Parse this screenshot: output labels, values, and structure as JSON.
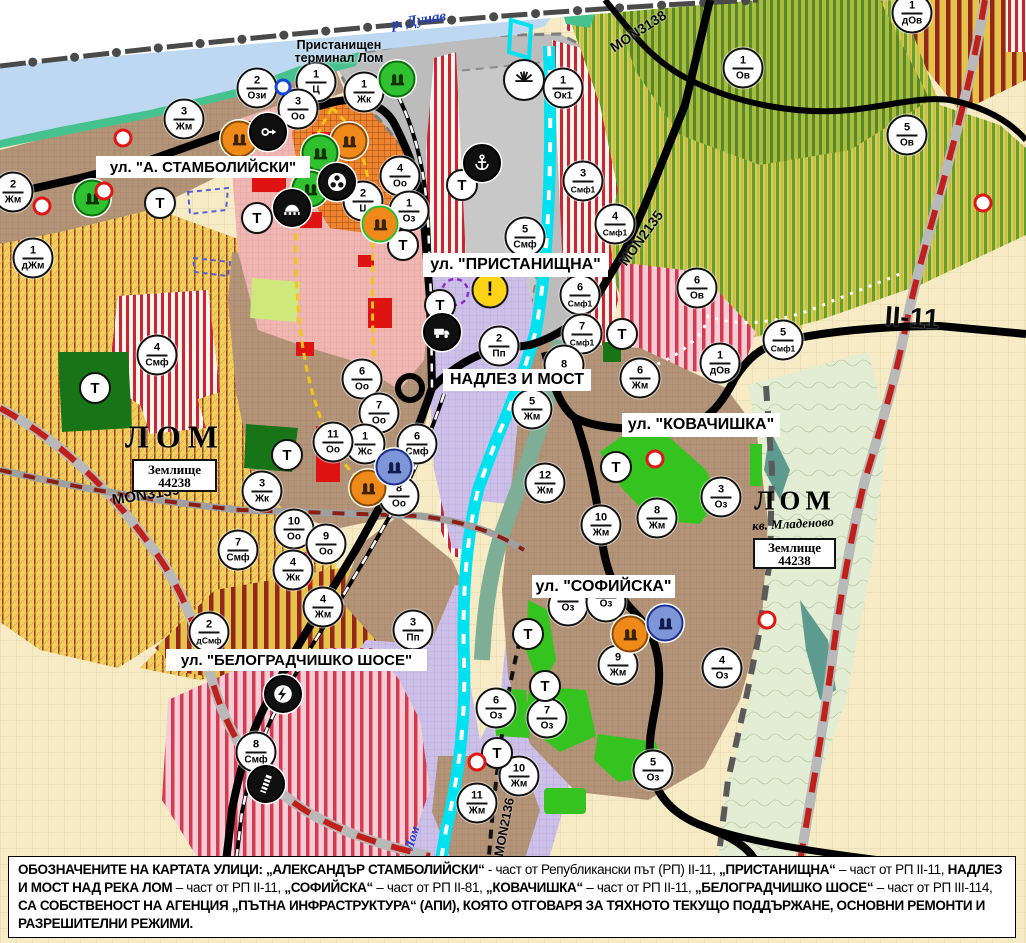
{
  "map": {
    "colors": {
      "water": "#bdd8f0",
      "coast": "#46c28e",
      "port_gray": "#bcbcbc",
      "smf_red": "#c92632",
      "residential_brown": "#b39478",
      "industrial_lavender": "#cdc0e8",
      "agri_yellow": "#f0d058",
      "vineyard_green": "#649f2e",
      "park_green": "#35c41f",
      "fields_cream": "#f6ebc4",
      "channel_cyan": "#00e2f0",
      "boundary_red": "#c0201a",
      "road_black": "#000000"
    },
    "street_labels": [
      {
        "id": "stambolijski",
        "text": "ул. \"А. СТАМБОЛИЙСКИ\"",
        "x": 96,
        "y": 156,
        "w": 214,
        "h": 22,
        "fs": 15
      },
      {
        "id": "pristanishtna",
        "text": "ул. \"ПРИСТАНИЩНА\"",
        "x": 423,
        "y": 253,
        "w": 185,
        "h": 24,
        "fs": 16
      },
      {
        "id": "nadlez-i-most",
        "text": "НАДЛЕЗ И МОСТ",
        "x": 443,
        "y": 369,
        "w": 148,
        "h": 22,
        "fs": 16
      },
      {
        "id": "kovachishka",
        "text": "ул. \"КОВАЧИШКА\"",
        "x": 622,
        "y": 413,
        "w": 158,
        "h": 24,
        "fs": 16
      },
      {
        "id": "sofijska",
        "text": "ул. \"СОФИЙСКА\"",
        "x": 532,
        "y": 575,
        "w": 143,
        "h": 23,
        "fs": 16
      },
      {
        "id": "belogradchishko",
        "text": "ул. \"БЕЛОГРАДЧИШКО ШОСЕ\"",
        "x": 166,
        "y": 649,
        "w": 261,
        "h": 22,
        "fs": 15
      }
    ],
    "place_labels": [
      {
        "id": "r-dunav",
        "text": "р. Дунав",
        "x": 419,
        "y": 21,
        "rot": -9,
        "fs": 15,
        "cls": "lbl-dunav"
      },
      {
        "id": "port-terminal",
        "text": "Пристанищен\nтерминал Лом",
        "x": 339,
        "y": 52,
        "rot": 0,
        "fs": 12.5,
        "cls": "lbl-terminal"
      },
      {
        "id": "lom-city",
        "text": "ЛОМ",
        "x": 175,
        "y": 437,
        "rot": 0,
        "fs": 32,
        "cls": "lbl-lom-big"
      },
      {
        "id": "lom-mladenovo",
        "text": "ЛОМ",
        "x": 795,
        "y": 501,
        "rot": 0,
        "fs": 27,
        "cls": "lbl-lom-big2"
      },
      {
        "id": "kv-mladenovo",
        "text": "кв. Младеново",
        "x": 793,
        "y": 524,
        "rot": -3,
        "fs": 13,
        "cls": "lbl-mladenovo"
      },
      {
        "id": "lom-river",
        "text": "Лом",
        "x": 412,
        "y": 838,
        "rot": -73,
        "fs": 13,
        "cls": "lbl-lom-river"
      }
    ],
    "road_labels": [
      {
        "id": "mon3139",
        "text": "MON3139",
        "x": 146,
        "y": 495,
        "rot": -9,
        "fs": 15
      },
      {
        "id": "mon3138",
        "text": "MON3138",
        "x": 638,
        "y": 31,
        "rot": -33,
        "fs": 14
      },
      {
        "id": "mon2135",
        "text": "MON2135",
        "x": 641,
        "y": 238,
        "rot": -54,
        "fs": 14
      },
      {
        "id": "mon2136",
        "text": "MON2136",
        "x": 504,
        "y": 827,
        "rot": -79,
        "fs": 13
      },
      {
        "id": "ii-11",
        "text": "II-11",
        "x": 912,
        "y": 318,
        "rot": 4,
        "fs": 28
      }
    ],
    "area_boxes": [
      {
        "id": "zemlishte-west",
        "line1": "Землище",
        "line2": "44238",
        "x": 132,
        "y": 459,
        "w": 81,
        "h": 29
      },
      {
        "id": "zemlishte-east",
        "line1": "Землище",
        "line2": "44238",
        "x": 753,
        "y": 538,
        "w": 79,
        "h": 27
      }
    ],
    "zone_markers": [
      {
        "n": "2",
        "z": "Ози",
        "x": 257,
        "y": 88
      },
      {
        "n": "1",
        "z": "Ц",
        "x": 316,
        "y": 82
      },
      {
        "n": "3",
        "z": "Оо",
        "x": 298,
        "y": 109
      },
      {
        "n": "1",
        "z": "Жк",
        "x": 364,
        "y": 92
      },
      {
        "n": "1",
        "z": "Ок1",
        "x": 563,
        "y": 88
      },
      {
        "n": "3",
        "z": "Жм",
        "x": 184,
        "y": 119
      },
      {
        "n": "4",
        "z": "Оо",
        "x": 400,
        "y": 176
      },
      {
        "n": "2",
        "z": "Ц",
        "x": 363,
        "y": 201
      },
      {
        "n": "1",
        "z": "Оз",
        "x": 409,
        "y": 211
      },
      {
        "n": "2",
        "z": "Жм",
        "x": 13,
        "y": 192
      },
      {
        "n": "1",
        "z": "дЖм",
        "x": 33,
        "y": 258
      },
      {
        "n": "4",
        "z": "Смф",
        "x": 157,
        "y": 355
      },
      {
        "n": "3",
        "z": "Смф1",
        "x": 583,
        "y": 181
      },
      {
        "n": "4",
        "z": "Смф1",
        "x": 615,
        "y": 224
      },
      {
        "n": "5",
        "z": "Смф",
        "x": 525,
        "y": 237
      },
      {
        "n": "6",
        "z": "Смф1",
        "x": 580,
        "y": 295
      },
      {
        "n": "7",
        "z": "Смф1",
        "x": 582,
        "y": 334
      },
      {
        "n": "2",
        "z": "Пп",
        "x": 499,
        "y": 346
      },
      {
        "n": "8",
        "z": "",
        "x": 564,
        "y": 365
      },
      {
        "n": "5",
        "z": "Жм",
        "x": 532,
        "y": 409
      },
      {
        "n": "6",
        "z": "Жм",
        "x": 640,
        "y": 378
      },
      {
        "n": "6",
        "z": "Оо",
        "x": 362,
        "y": 379
      },
      {
        "n": "7",
        "z": "Оо",
        "x": 379,
        "y": 413
      },
      {
        "n": "1",
        "z": "Жс",
        "x": 365,
        "y": 444
      },
      {
        "n": "6",
        "z": "Смф",
        "x": 417,
        "y": 444
      },
      {
        "n": "8",
        "z": "Оо",
        "x": 399,
        "y": 496
      },
      {
        "n": "11",
        "z": "Оо",
        "x": 333,
        "y": 442
      },
      {
        "n": "3",
        "z": "Жк",
        "x": 262,
        "y": 491
      },
      {
        "n": "10",
        "z": "Оо",
        "x": 294,
        "y": 529
      },
      {
        "n": "9",
        "z": "Оо",
        "x": 326,
        "y": 544
      },
      {
        "n": "4",
        "z": "Жк",
        "x": 293,
        "y": 570
      },
      {
        "n": "4",
        "z": "Жм",
        "x": 323,
        "y": 607
      },
      {
        "n": "7",
        "z": "Смф",
        "x": 238,
        "y": 550
      },
      {
        "n": "2",
        "z": "дСмф",
        "x": 209,
        "y": 632
      },
      {
        "n": "3",
        "z": "Пп",
        "x": 413,
        "y": 630
      },
      {
        "n": "12",
        "z": "Жм",
        "x": 545,
        "y": 483
      },
      {
        "n": "10",
        "z": "Жм",
        "x": 601,
        "y": 525
      },
      {
        "n": "3",
        "z": "Оз",
        "x": 721,
        "y": 497
      },
      {
        "n": "8",
        "z": "Жм",
        "x": 657,
        "y": 518
      },
      {
        "n": "6",
        "z": "Ов",
        "x": 697,
        "y": 288
      },
      {
        "n": "5",
        "z": "Смф1",
        "x": 783,
        "y": 340
      },
      {
        "n": "1",
        "z": "дОв",
        "x": 720,
        "y": 363
      },
      {
        "n": "1",
        "z": "Ов",
        "x": 743,
        "y": 68
      },
      {
        "n": "5",
        "z": "Ов",
        "x": 907,
        "y": 135
      },
      {
        "n": "1",
        "z": "дОв",
        "x": 912,
        "y": 13
      },
      {
        "n": "9",
        "z": "Жм",
        "x": 618,
        "y": 665
      },
      {
        "n": "4",
        "z": "Оз",
        "x": 722,
        "y": 668
      },
      {
        "n": "6",
        "z": "Оз",
        "x": 496,
        "y": 708
      },
      {
        "n": "7",
        "z": "Оз",
        "x": 547,
        "y": 718
      },
      {
        "n": "5",
        "z": "Оз",
        "x": 653,
        "y": 770
      },
      {
        "n": "10",
        "z": "Жм",
        "x": 519,
        "y": 776
      },
      {
        "n": "11",
        "z": "Жм",
        "x": 477,
        "y": 803
      },
      {
        "n": "8",
        "z": "Смф",
        "x": 256,
        "y": 752
      },
      {
        "n": "",
        "z": "Оз",
        "x": 568,
        "y": 606
      },
      {
        "n": "",
        "z": "Оз",
        "x": 606,
        "y": 602
      }
    ],
    "t_markers": [
      {
        "x": 160,
        "y": 203
      },
      {
        "x": 257,
        "y": 218
      },
      {
        "x": 95,
        "y": 388
      },
      {
        "x": 287,
        "y": 455
      },
      {
        "x": 403,
        "y": 245
      },
      {
        "x": 440,
        "y": 305
      },
      {
        "x": 462,
        "y": 185
      },
      {
        "x": 622,
        "y": 334
      },
      {
        "x": 616,
        "y": 467
      },
      {
        "x": 528,
        "y": 634
      },
      {
        "x": 545,
        "y": 686
      },
      {
        "x": 497,
        "y": 753
      }
    ],
    "icon_markers": [
      {
        "icon": "monument",
        "variant": "orange",
        "x": 239,
        "y": 139
      },
      {
        "icon": "monument",
        "variant": "orange",
        "x": 349,
        "y": 141
      },
      {
        "icon": "monument",
        "variant": "orange",
        "x": 368,
        "y": 488
      },
      {
        "icon": "monument",
        "variant": "orange",
        "x": 630,
        "y": 634
      },
      {
        "icon": "monument",
        "variant": "orange-ring",
        "x": 380,
        "y": 224
      },
      {
        "icon": "monument",
        "variant": "green",
        "x": 397,
        "y": 79
      },
      {
        "icon": "monument",
        "variant": "green",
        "x": 320,
        "y": 153
      },
      {
        "icon": "monument",
        "variant": "green",
        "x": 92,
        "y": 198
      },
      {
        "icon": "monument",
        "variant": "green",
        "x": 310,
        "y": 189
      },
      {
        "icon": "monument",
        "variant": "blue",
        "x": 394,
        "y": 467
      },
      {
        "icon": "monument",
        "variant": "blue",
        "x": 665,
        "y": 623
      },
      {
        "icon": "arrow-right",
        "variant": "black",
        "x": 268,
        "y": 132
      },
      {
        "icon": "people",
        "variant": "black",
        "x": 337,
        "y": 182
      },
      {
        "icon": "tunnel",
        "variant": "black",
        "x": 292,
        "y": 208
      },
      {
        "icon": "anchor",
        "variant": "black",
        "x": 482,
        "y": 163
      },
      {
        "icon": "truck",
        "variant": "black",
        "x": 442,
        "y": 332
      },
      {
        "icon": "lightning",
        "variant": "black",
        "x": 283,
        "y": 694
      },
      {
        "icon": "rail-crossing",
        "variant": "black",
        "x": 266,
        "y": 784
      },
      {
        "icon": "sun",
        "variant": "sun",
        "x": 524,
        "y": 80
      },
      {
        "icon": "warning",
        "variant": "warning",
        "x": 490,
        "y": 290
      }
    ],
    "dot_markers": [
      {
        "c": "red",
        "x": 104,
        "y": 191
      },
      {
        "c": "red",
        "x": 42,
        "y": 206
      },
      {
        "c": "red",
        "x": 123,
        "y": 138
      },
      {
        "c": "red",
        "x": 655,
        "y": 459
      },
      {
        "c": "red",
        "x": 767,
        "y": 620
      },
      {
        "c": "red",
        "x": 983,
        "y": 203
      },
      {
        "c": "red",
        "x": 477,
        "y": 762
      },
      {
        "c": "blue",
        "x": 283,
        "y": 87
      }
    ],
    "caption": {
      "segments": [
        {
          "t": "ОБОЗНАЧЕНИТЕ НА КАРТАТА УЛИЦИ: „АЛЕКСАНДЪР СТАМБОЛИЙСКИ“",
          "b": true
        },
        {
          "t": " - част от Републикански път (РП) II-11, ",
          "b": false
        },
        {
          "t": "„ПРИСТАНИЩНА“",
          "b": true
        },
        {
          "t": " – част от РП II-11, ",
          "b": false
        },
        {
          "t": "НАДЛЕЗ И МОСТ НАД РЕКА ЛОМ",
          "b": true
        },
        {
          "t": " – част от РП II-11, ",
          "b": false
        },
        {
          "t": "„СОФИЙСКА“",
          "b": true
        },
        {
          "t": " – част от РП II-81, ",
          "b": false
        },
        {
          "t": "„КОВАЧИШКА“",
          "b": true
        },
        {
          "t": " – част от РП II-11, ",
          "b": false
        },
        {
          "t": "„БЕЛОГРАДЧИШКО ШОСЕ“",
          "b": true
        },
        {
          "t": " – част от РП III-114, ",
          "b": false
        },
        {
          "t": "СА СОБСТВЕНОСТ НА АГЕНЦИЯ „ПЪТНА ИНФРАСТРУКТУРА“ (АПИ), КОЯТО ОТГОВАРЯ ЗА ТЯХНОТО ТЕКУЩО ПОДДЪРЖАНЕ, ОСНОВНИ РЕМОНТИ И РАЗРЕШИТЕЛНИ РЕЖИМИ.",
          "b": true
        }
      ]
    }
  }
}
